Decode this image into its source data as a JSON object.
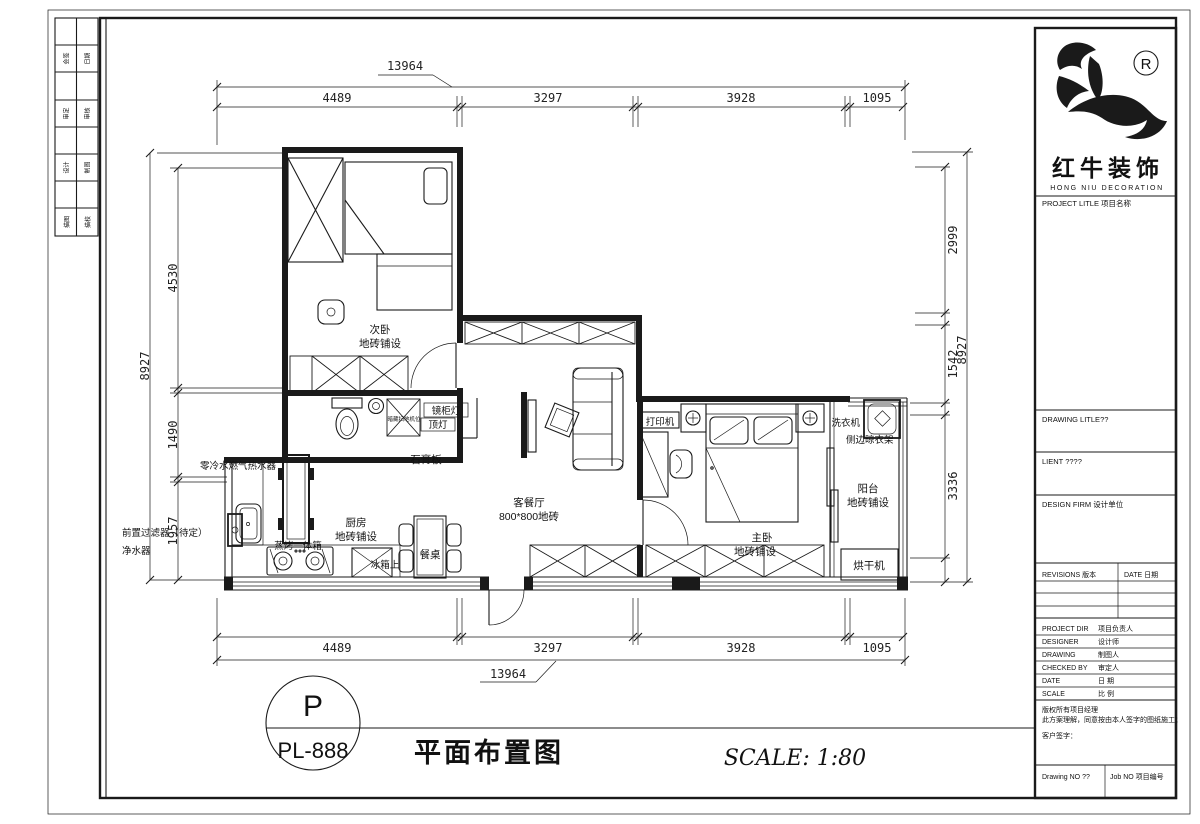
{
  "edge_strip": {
    "cells": [
      "会签",
      "日期",
      "审定",
      "审核",
      "设计",
      "制图",
      "描图",
      "描校"
    ]
  },
  "logo": {
    "registered": "®",
    "brand": "红牛装饰",
    "brand_en": "HONG NIU DECORATION"
  },
  "title_block": {
    "project_label": "PROJECT LITLE  项目名称",
    "drawing_label": "DRAWING LITLE??",
    "client_label": "LIENT ????",
    "design_firm_label": "DESIGN FIRM 设计单位",
    "revisions_label": "REVISIONS 版本",
    "revisions_date_label": "DATE 日期",
    "rows": [
      {
        "en": "PROJECT DIR",
        "zh": "项目负责人"
      },
      {
        "en": "DESIGNER",
        "zh": "设计师"
      },
      {
        "en": "DRAWING",
        "zh": "制图人"
      },
      {
        "en": "CHECKED BY",
        "zh": "审定人"
      },
      {
        "en": "DATE",
        "zh": "日 期"
      },
      {
        "en": "SCALE",
        "zh": "比 例"
      }
    ],
    "note_line1": "版权所有项目经理",
    "note_line2": "此方案理解，同意按由本人签字的图纸施工；",
    "note_line3": "客户签字：",
    "drawing_no_label": "Drawing NO ??",
    "job_no_label": "Job NO 项目编号"
  },
  "dimensions": {
    "top": {
      "overall": "13964",
      "chain": [
        "4489",
        "3297",
        "3928",
        "1095"
      ]
    },
    "bottom": {
      "overall": "13964",
      "chain": [
        "4489",
        "3297",
        "3928",
        "1095"
      ]
    },
    "left": {
      "overall": "8927",
      "chain": [
        "4530",
        "1490",
        "1957"
      ]
    },
    "right": {
      "overall": "8927",
      "chain": [
        "2999",
        "1542",
        "3336"
      ]
    }
  },
  "plan": {
    "rooms": {
      "bed2": "次卧",
      "bed2_sub": "地砖铺设",
      "living": "客餐厅",
      "living_sub": "800*800地砖",
      "master": "主卧",
      "master_sub": "地砖铺设",
      "kitchen": "厨房",
      "kitchen_sub": "地砖铺设",
      "balcony": "阳台",
      "balcony_sub": "地砖铺设"
    },
    "annotations": {
      "water_heater": "零冷水燃气热水器",
      "prefilter": "前置过滤器（待定）",
      "purifier": "净水器",
      "steam_oven": "蒸烤一体箱",
      "fridge": "冰箱上",
      "dining_table": "餐桌",
      "gypsum_board": "石膏板",
      "mirror_light": "镜柜灯",
      "ceiling_light": "顶灯",
      "robot_vacuum": "暗藏扫地机位",
      "printer": "打印机",
      "washer": "洗衣机",
      "side_rack": "侧边晾衣架",
      "dryer": "烘干机"
    }
  },
  "title_bar": {
    "sheet_letter": "P",
    "sheet_number": "PL-888",
    "drawing_title": "平面布置图",
    "scale_text": "SCALE: 1:80"
  }
}
